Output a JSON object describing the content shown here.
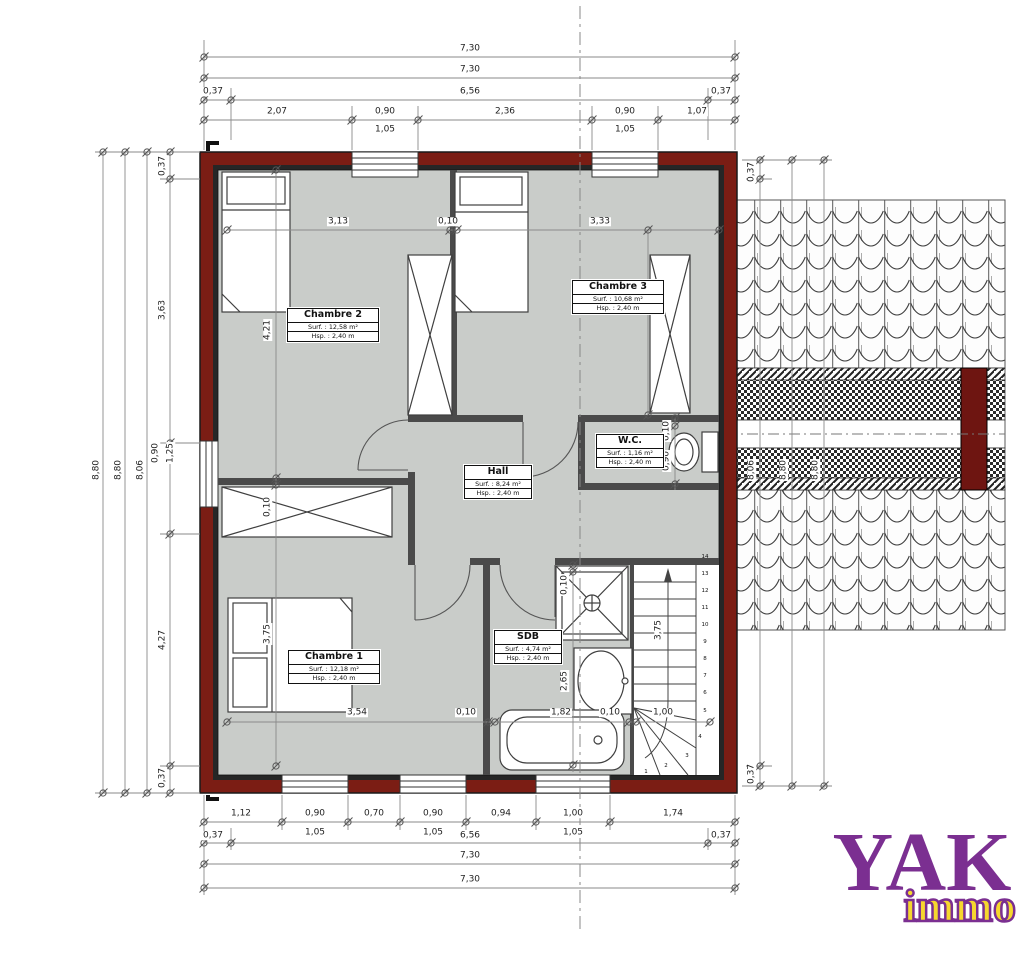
{
  "logo": {
    "name": "YAK",
    "sub": "immo",
    "purple": "#7b2f91",
    "yellow": "#f6d72e"
  },
  "colors": {
    "wall_red": "#7b1d14",
    "floor_gray": "#c9ccc9"
  },
  "rooms": [
    {
      "name": "Chambre 2",
      "surface": "Surf. : 12,58 m²",
      "height": "Hsp. : 2,40 m",
      "left": 287,
      "top": 308,
      "w": 90
    },
    {
      "name": "Chambre 3",
      "surface": "Surf. : 10,68 m²",
      "height": "Hsp. : 2,40 m",
      "left": 572,
      "top": 280,
      "w": 90
    },
    {
      "name": "W.C.",
      "surface": "Surf. : 1,16 m²",
      "height": "Hsp. : 2,40 m",
      "left": 596,
      "top": 434,
      "w": 66
    },
    {
      "name": "Hall",
      "surface": "Surf. : 8,24 m²",
      "height": "Hsp. : 2,40 m",
      "left": 464,
      "top": 465,
      "w": 66
    },
    {
      "name": "SDB",
      "surface": "Surf. : 4,74 m²",
      "height": "Hsp. : 2,40 m",
      "left": 494,
      "top": 630,
      "w": 66
    },
    {
      "name": "Chambre 1",
      "surface": "Surf. : 12,18 m²",
      "height": "Hsp. : 2,40 m",
      "left": 288,
      "top": 650,
      "w": 90
    }
  ],
  "stairs": {
    "numbers": [
      {
        "n": "14",
        "x": 705,
        "y": 557
      },
      {
        "n": "13",
        "x": 705,
        "y": 574
      },
      {
        "n": "12",
        "x": 705,
        "y": 591
      },
      {
        "n": "11",
        "x": 705,
        "y": 608
      },
      {
        "n": "10",
        "x": 705,
        "y": 625
      },
      {
        "n": "9",
        "x": 705,
        "y": 642
      },
      {
        "n": "8",
        "x": 705,
        "y": 659
      },
      {
        "n": "7",
        "x": 705,
        "y": 676
      },
      {
        "n": "6",
        "x": 705,
        "y": 693
      },
      {
        "n": "5",
        "x": 705,
        "y": 711
      },
      {
        "n": "4",
        "x": 700,
        "y": 737
      },
      {
        "n": "3",
        "x": 687,
        "y": 756
      },
      {
        "n": "2",
        "x": 666,
        "y": 766
      },
      {
        "n": "1",
        "x": 646,
        "y": 772
      }
    ]
  },
  "dim_labels": [
    {
      "t": "7,30",
      "x": 470,
      "y": 49
    },
    {
      "t": "7,30",
      "x": 470,
      "y": 70
    },
    {
      "t": "0,37",
      "x": 213,
      "y": 92
    },
    {
      "t": "6,56",
      "x": 470,
      "y": 92
    },
    {
      "t": "0,37",
      "x": 721,
      "y": 92
    },
    {
      "t": "2,07",
      "x": 277,
      "y": 112
    },
    {
      "t": "0,90",
      "x": 385,
      "y": 112
    },
    {
      "t": "2,36",
      "x": 505,
      "y": 112
    },
    {
      "t": "0,90",
      "x": 625,
      "y": 112
    },
    {
      "t": "1,07",
      "x": 697,
      "y": 112
    },
    {
      "t": "1,05",
      "x": 385,
      "y": 130
    },
    {
      "t": "1,05",
      "x": 625,
      "y": 130
    },
    {
      "t": "1,12",
      "x": 241,
      "y": 814
    },
    {
      "t": "0,90",
      "x": 315,
      "y": 814
    },
    {
      "t": "0,70",
      "x": 374,
      "y": 814
    },
    {
      "t": "0,90",
      "x": 433,
      "y": 814
    },
    {
      "t": "0,94",
      "x": 501,
      "y": 814
    },
    {
      "t": "1,00",
      "x": 573,
      "y": 814
    },
    {
      "t": "1,74",
      "x": 673,
      "y": 814
    },
    {
      "t": "1,05",
      "x": 315,
      "y": 833
    },
    {
      "t": "1,05",
      "x": 433,
      "y": 833
    },
    {
      "t": "1,05",
      "x": 573,
      "y": 833
    },
    {
      "t": "0,37",
      "x": 213,
      "y": 836
    },
    {
      "t": "6,56",
      "x": 470,
      "y": 836
    },
    {
      "t": "0,37",
      "x": 721,
      "y": 836
    },
    {
      "t": "7,30",
      "x": 470,
      "y": 856
    },
    {
      "t": "7,30",
      "x": 470,
      "y": 880
    },
    {
      "t": "8,80",
      "x": 97,
      "y": 470,
      "r": -90
    },
    {
      "t": "8,80",
      "x": 119,
      "y": 470,
      "r": -90
    },
    {
      "t": "8,06",
      "x": 141,
      "y": 470,
      "r": -90
    },
    {
      "t": "0,37",
      "x": 163,
      "y": 166,
      "r": -90
    },
    {
      "t": "3,63",
      "x": 163,
      "y": 310,
      "r": -90
    },
    {
      "t": "0,90",
      "x": 156,
      "y": 453,
      "r": -90
    },
    {
      "t": "1,25",
      "x": 171,
      "y": 453,
      "r": -90
    },
    {
      "t": "4,27",
      "x": 163,
      "y": 640,
      "r": -90
    },
    {
      "t": "0,37",
      "x": 163,
      "y": 778,
      "r": -90
    },
    {
      "t": "0,37",
      "x": 752,
      "y": 172,
      "r": -90
    },
    {
      "t": "8,06",
      "x": 752,
      "y": 470,
      "r": -90
    },
    {
      "t": "8,80",
      "x": 784,
      "y": 470,
      "r": -90
    },
    {
      "t": "8,80",
      "x": 816,
      "y": 470,
      "r": -90
    },
    {
      "t": "0,37",
      "x": 752,
      "y": 774,
      "r": -90
    },
    {
      "t": "3,13",
      "x": 338,
      "y": 222
    },
    {
      "t": "0,10",
      "x": 448,
      "y": 222
    },
    {
      "t": "3,33",
      "x": 600,
      "y": 222
    },
    {
      "t": "4,21",
      "x": 268,
      "y": 330,
      "r": -90
    },
    {
      "t": "0,10",
      "x": 268,
      "y": 507,
      "r": -90
    },
    {
      "t": "3,75",
      "x": 268,
      "y": 634,
      "r": -90
    },
    {
      "t": "3,21",
      "x": 640,
      "y": 300,
      "r": -90
    },
    {
      "t": "0,10",
      "x": 667,
      "y": 431,
      "r": -90
    },
    {
      "t": "0,90",
      "x": 667,
      "y": 461,
      "r": -90
    },
    {
      "t": "0,10",
      "x": 565,
      "y": 585,
      "r": -90
    },
    {
      "t": "2,65",
      "x": 565,
      "y": 681,
      "r": -90
    },
    {
      "t": "3,75",
      "x": 659,
      "y": 630,
      "r": -90
    },
    {
      "t": "3,54",
      "x": 357,
      "y": 713
    },
    {
      "t": "0,10",
      "x": 466,
      "y": 713
    },
    {
      "t": "1,82",
      "x": 561,
      "y": 713
    },
    {
      "t": "0,10",
      "x": 610,
      "y": 713
    },
    {
      "t": "1,00",
      "x": 663,
      "y": 713
    }
  ]
}
